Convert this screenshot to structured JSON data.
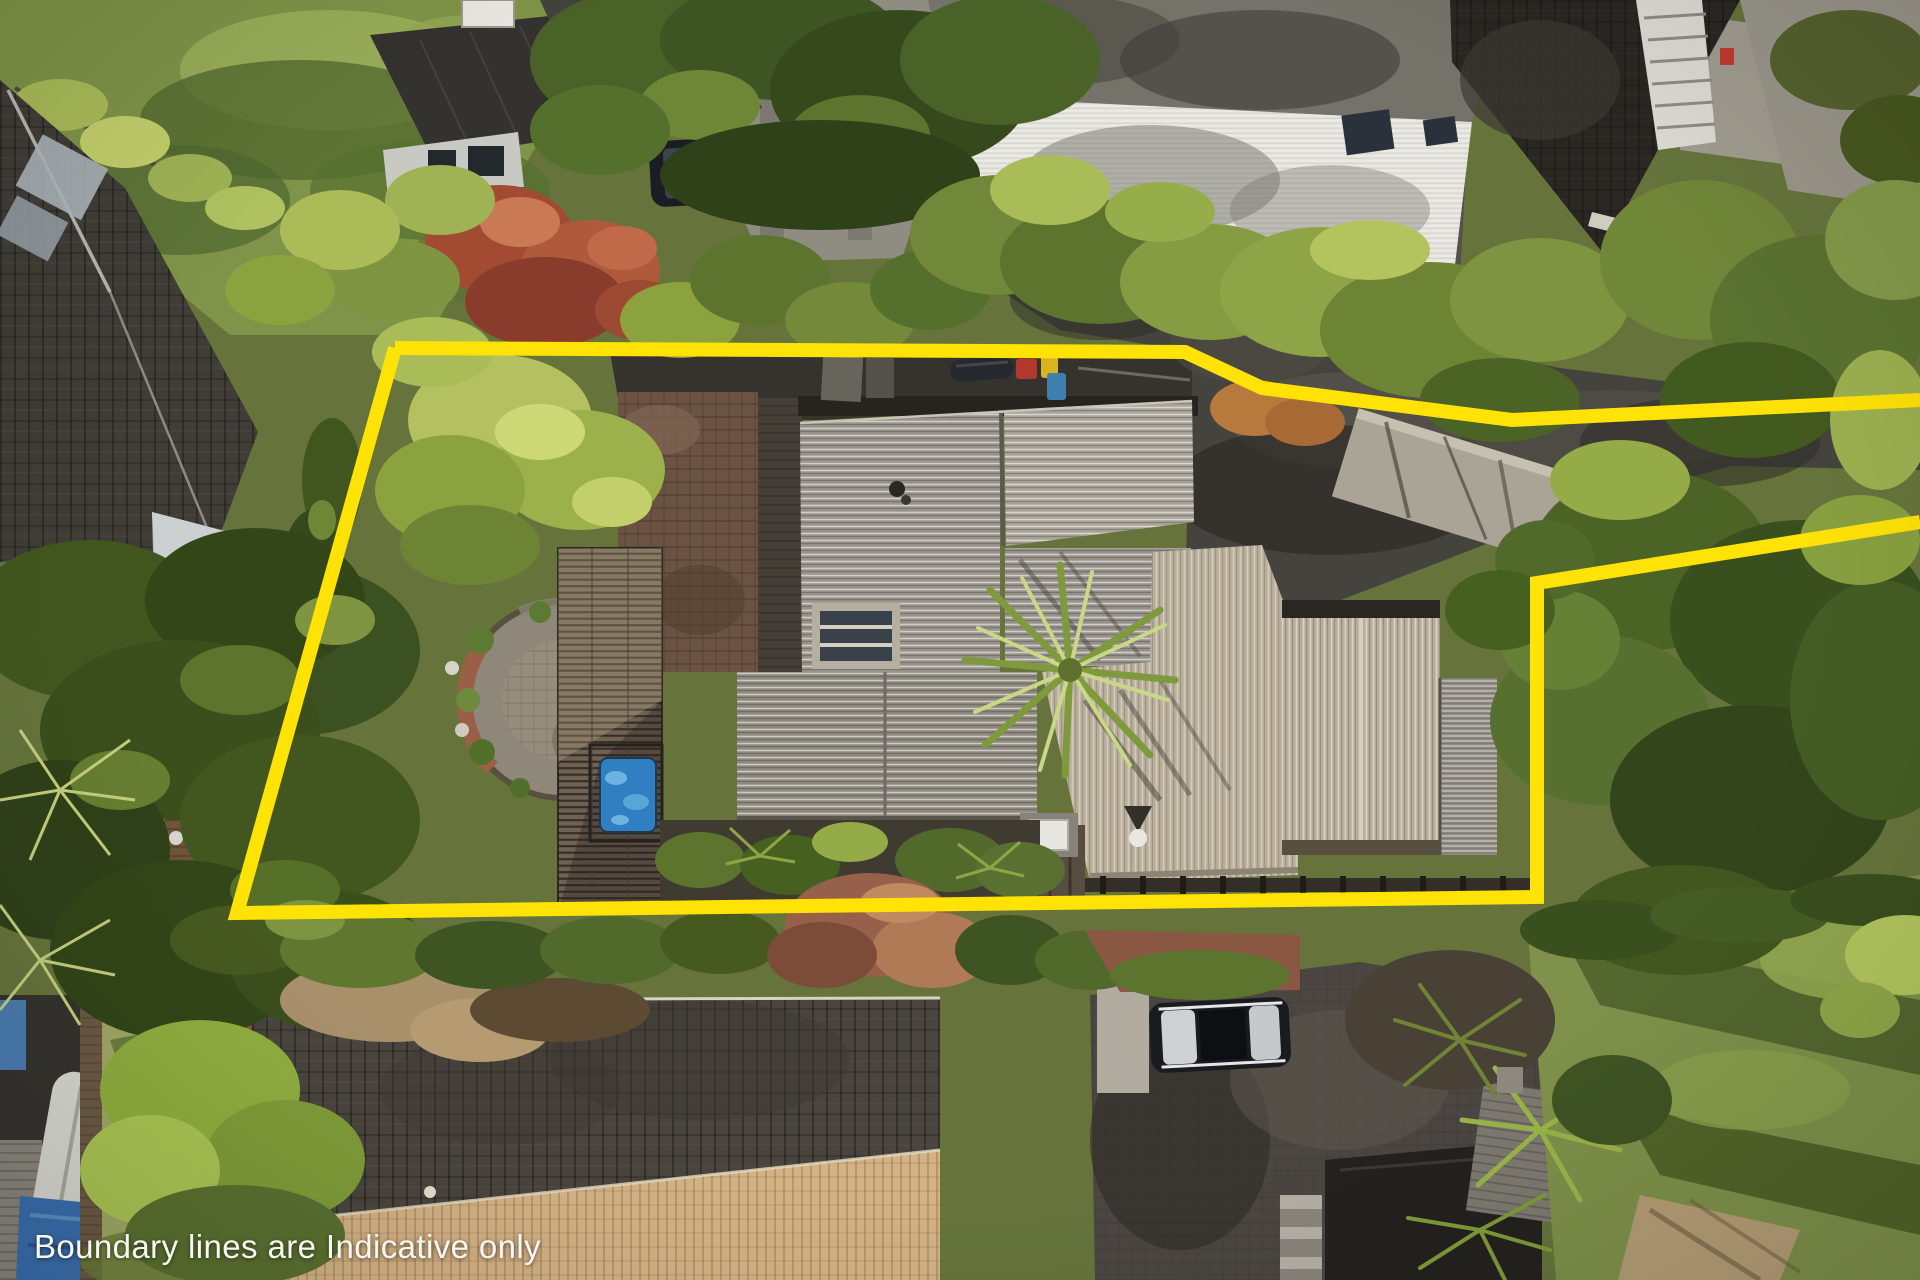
{
  "overlay": {
    "caption": "Boundary lines are Indicative only",
    "caption_color": "#f7f6f2",
    "boundary_color": "#ffe206",
    "boundary_width": "14",
    "segments": {
      "top": "395,348 1185,352 1262,388 1512,420 1920,400",
      "main": "1920,522 1537,583 1537,897 237,913 395,348"
    }
  },
  "scene": {
    "type": "aerial-photograph",
    "subject": "top-down drone photo of a residential property outlined with an indicative yellow boundary",
    "palette": {
      "foliage_dark": "#3a4f1e",
      "foliage_mid": "#66743c",
      "foliage_bright": "#b4c160",
      "lawn": "#7f9448",
      "asphalt": "#45433d",
      "concrete": "#8f8c82",
      "roof_grey": "#98938a",
      "roof_grey_light": "#a8a298",
      "roof_tan": "#b9ae9a",
      "roof_dark": "#403d37",
      "tile_house": "#4a443e",
      "tile_sunlit": "#d3b285",
      "pool_blue": "#2f7fc2",
      "red_tree": "#a34a33",
      "deck_brown": "#7d5f41"
    }
  }
}
